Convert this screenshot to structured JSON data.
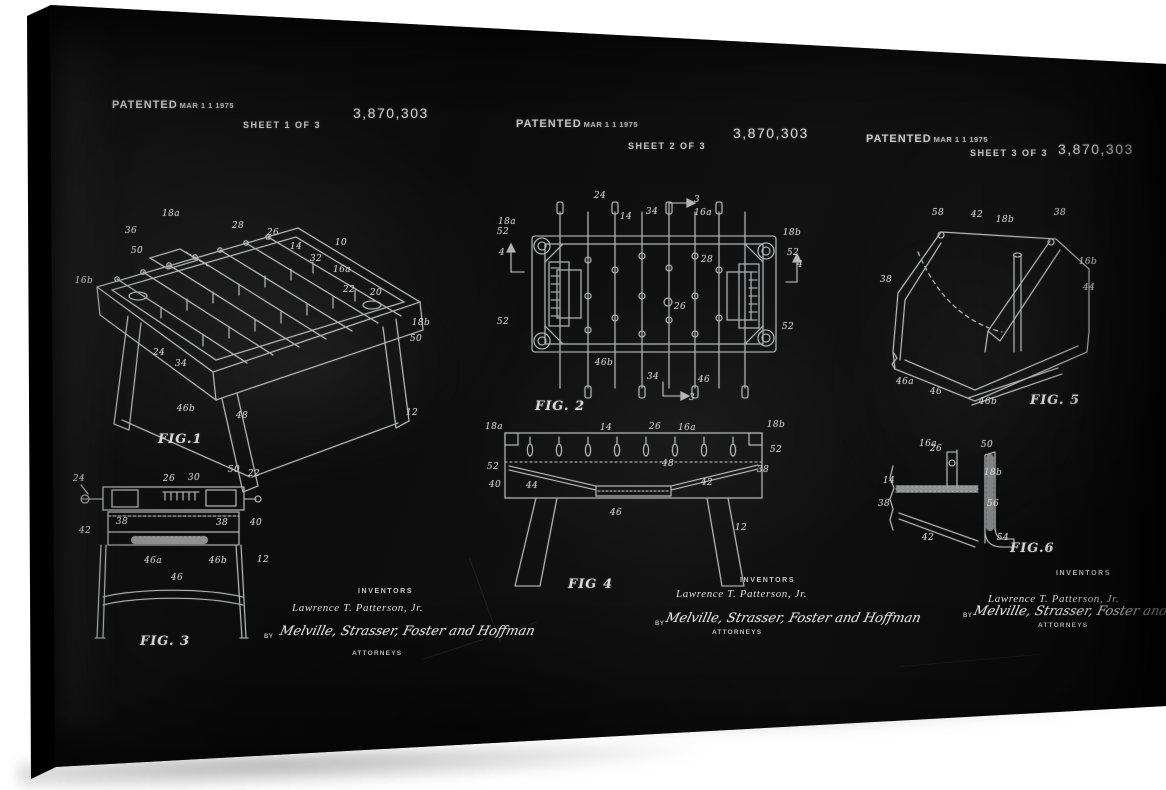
{
  "patent": {
    "patented": "PATENTED",
    "date": "MAR 1 1 1975",
    "number": "3,870,303",
    "sheets": [
      "SHEET 1 OF 3",
      "SHEET 2 OF 3",
      "SHEET 3 OF 3"
    ]
  },
  "signature": {
    "inventors_heading": "INVENTORS",
    "inventor_name": "Lawrence T. Patterson, Jr.",
    "by_label": "BY",
    "attorneys_signature": "Melville, Strasser, Foster and Hoffman",
    "attorneys_heading": "ATTORNEYS"
  },
  "colors": {
    "board": "#0d0d0d",
    "chalk": "#d6d6d6",
    "background": "#ffffff"
  },
  "figures": {
    "fig1": {
      "caption": "FIG.1",
      "labels": [
        {
          "t": "18a",
          "x": 171,
          "y": 214
        },
        {
          "t": "36",
          "x": 131,
          "y": 231
        },
        {
          "t": "50",
          "x": 137,
          "y": 251
        },
        {
          "t": "28",
          "x": 238,
          "y": 226
        },
        {
          "t": "26",
          "x": 273,
          "y": 233
        },
        {
          "t": "14",
          "x": 296,
          "y": 247
        },
        {
          "t": "10",
          "x": 341,
          "y": 243
        },
        {
          "t": "32",
          "x": 316,
          "y": 259
        },
        {
          "t": "16a",
          "x": 342,
          "y": 270
        },
        {
          "t": "22",
          "x": 349,
          "y": 290
        },
        {
          "t": "20",
          "x": 376,
          "y": 293
        },
        {
          "t": "18b",
          "x": 421,
          "y": 323
        },
        {
          "t": "50",
          "x": 416,
          "y": 339
        },
        {
          "t": "16b",
          "x": 84,
          "y": 281
        },
        {
          "t": "24",
          "x": 159,
          "y": 353
        },
        {
          "t": "34",
          "x": 181,
          "y": 364
        },
        {
          "t": "46b",
          "x": 186,
          "y": 409
        },
        {
          "t": "48",
          "x": 242,
          "y": 416
        },
        {
          "t": "12",
          "x": 412,
          "y": 413
        }
      ]
    },
    "fig2": {
      "caption": "FIG. 2",
      "labels": [
        {
          "t": "24",
          "x": 600,
          "y": 196
        },
        {
          "t": "3",
          "x": 697,
          "y": 200
        },
        {
          "t": "14",
          "x": 626,
          "y": 217
        },
        {
          "t": "34",
          "x": 652,
          "y": 212
        },
        {
          "t": "16a",
          "x": 703,
          "y": 213
        },
        {
          "t": "18a",
          "x": 507,
          "y": 222
        },
        {
          "t": "52",
          "x": 503,
          "y": 232
        },
        {
          "t": "18b",
          "x": 792,
          "y": 233
        },
        {
          "t": "52",
          "x": 793,
          "y": 253
        },
        {
          "t": "4",
          "x": 502,
          "y": 253
        },
        {
          "t": "4",
          "x": 800,
          "y": 265
        },
        {
          "t": "28",
          "x": 707,
          "y": 260
        },
        {
          "t": "26",
          "x": 680,
          "y": 307
        },
        {
          "t": "52",
          "x": 503,
          "y": 322
        },
        {
          "t": "52",
          "x": 788,
          "y": 327
        },
        {
          "t": "46b",
          "x": 604,
          "y": 363
        },
        {
          "t": "34",
          "x": 653,
          "y": 377
        },
        {
          "t": "46",
          "x": 704,
          "y": 380
        },
        {
          "t": "3",
          "x": 692,
          "y": 398
        }
      ]
    },
    "fig3": {
      "caption": "FIG. 3",
      "labels": [
        {
          "t": "24",
          "x": 79,
          "y": 479
        },
        {
          "t": "26",
          "x": 169,
          "y": 479
        },
        {
          "t": "30",
          "x": 194,
          "y": 478
        },
        {
          "t": "50",
          "x": 234,
          "y": 470
        },
        {
          "t": "22",
          "x": 254,
          "y": 474
        },
        {
          "t": "38",
          "x": 122,
          "y": 522
        },
        {
          "t": "38",
          "x": 222,
          "y": 523
        },
        {
          "t": "40",
          "x": 256,
          "y": 523
        },
        {
          "t": "42",
          "x": 85,
          "y": 531
        },
        {
          "t": "46a",
          "x": 153,
          "y": 561
        },
        {
          "t": "46",
          "x": 177,
          "y": 578
        },
        {
          "t": "46b",
          "x": 218,
          "y": 561
        },
        {
          "t": "12",
          "x": 263,
          "y": 560
        }
      ]
    },
    "fig4": {
      "caption": "FIG 4",
      "labels": [
        {
          "t": "18a",
          "x": 494,
          "y": 427
        },
        {
          "t": "14",
          "x": 606,
          "y": 428
        },
        {
          "t": "26",
          "x": 655,
          "y": 427
        },
        {
          "t": "16a",
          "x": 687,
          "y": 428
        },
        {
          "t": "18b",
          "x": 776,
          "y": 425
        },
        {
          "t": "52",
          "x": 493,
          "y": 467
        },
        {
          "t": "52",
          "x": 776,
          "y": 450
        },
        {
          "t": "40",
          "x": 495,
          "y": 485
        },
        {
          "t": "44",
          "x": 532,
          "y": 486
        },
        {
          "t": "48",
          "x": 668,
          "y": 464
        },
        {
          "t": "42",
          "x": 707,
          "y": 483
        },
        {
          "t": "38",
          "x": 763,
          "y": 470
        },
        {
          "t": "46",
          "x": 616,
          "y": 513
        },
        {
          "t": "12",
          "x": 741,
          "y": 528
        }
      ]
    },
    "fig5": {
      "caption": "FIG. 5",
      "labels": [
        {
          "t": "58",
          "x": 938,
          "y": 213
        },
        {
          "t": "42",
          "x": 977,
          "y": 215
        },
        {
          "t": "18b",
          "x": 1005,
          "y": 220
        },
        {
          "t": "38",
          "x": 1060,
          "y": 213
        },
        {
          "t": "38",
          "x": 886,
          "y": 280
        },
        {
          "t": "16b",
          "x": 1088,
          "y": 262
        },
        {
          "t": "44",
          "x": 1089,
          "y": 288
        },
        {
          "t": "46a",
          "x": 905,
          "y": 382
        },
        {
          "t": "46",
          "x": 936,
          "y": 392
        },
        {
          "t": "46b",
          "x": 988,
          "y": 402
        }
      ]
    },
    "fig6": {
      "caption": "FIG.6",
      "labels": [
        {
          "t": "16a",
          "x": 928,
          "y": 444
        },
        {
          "t": "26",
          "x": 936,
          "y": 449
        },
        {
          "t": "50",
          "x": 987,
          "y": 445
        },
        {
          "t": "14",
          "x": 889,
          "y": 481
        },
        {
          "t": "18b",
          "x": 993,
          "y": 473
        },
        {
          "t": "38",
          "x": 884,
          "y": 504
        },
        {
          "t": "56",
          "x": 993,
          "y": 504
        },
        {
          "t": "42",
          "x": 928,
          "y": 538
        },
        {
          "t": "54",
          "x": 1003,
          "y": 538
        }
      ]
    }
  }
}
